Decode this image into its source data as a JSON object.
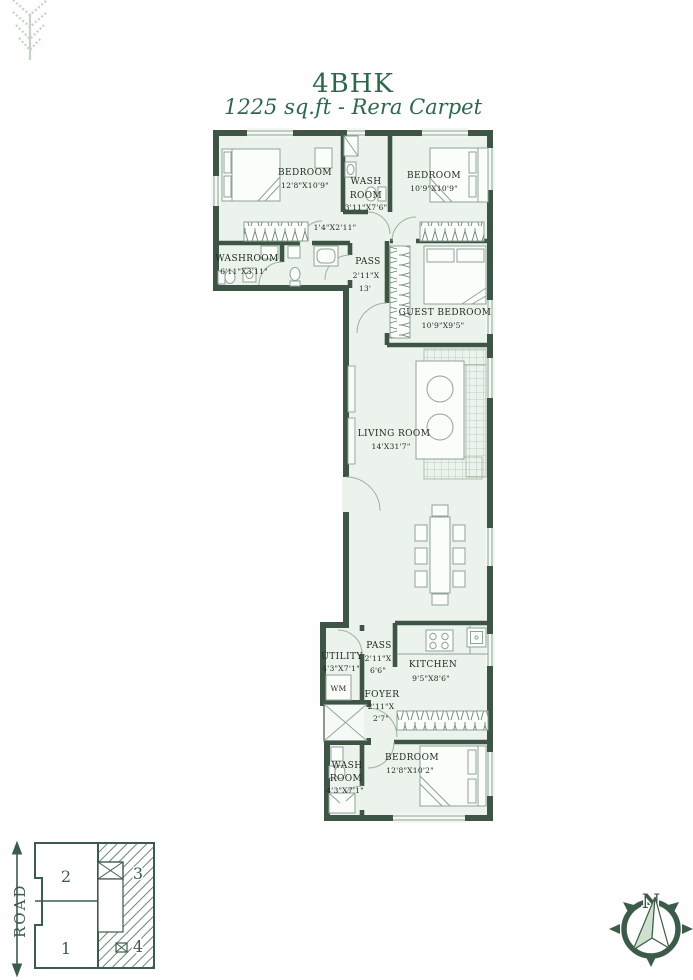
{
  "title": {
    "line1": "4BHK",
    "line2": "1225 sq.ft - Rera Carpet"
  },
  "colors": {
    "wall": "#3e5546",
    "floor": "#ecf3ed",
    "accent_green": "#2d684c",
    "furniture_line": "#8fa396",
    "label_text": "#222c1d",
    "keyplan_green": "#3d5b4a",
    "leaf_logo": "#c7d2c5"
  },
  "rooms": {
    "bedroom_top_left": {
      "name": "BEDROOM",
      "dims": "12'8\"X10'9\""
    },
    "washroom_top": {
      "name_line1": "WASH",
      "name_line2": "ROOM",
      "dims": "3'11\"X7'6\""
    },
    "bedroom_top_right": {
      "name": "BEDROOM",
      "dims": "10'9\"X10'9\""
    },
    "mini_passage": {
      "dims": "1'4\"X2'11\""
    },
    "washroom_left": {
      "name": "WASHROOM",
      "dims": "6'11\"X3'11\""
    },
    "passage_main": {
      "name": "PASS",
      "dims_line1": "2'11\"X",
      "dims_line2": "13'"
    },
    "guest_bedroom": {
      "name": "GUEST BEDROOM",
      "dims": "10'9\"X9'5\""
    },
    "living_room": {
      "name": "LIVING ROOM",
      "dims": "14'X31'7\""
    },
    "utility": {
      "name": "UTILITY",
      "dims": "4'3\"X7'1\"",
      "appliance": "WM"
    },
    "passage_kitchen": {
      "name": "PASS",
      "dims_line1": "2'11\"X",
      "dims_line2": "6'6\""
    },
    "kitchen": {
      "name": "KITCHEN",
      "dims": "9'5\"X8'6\""
    },
    "foyer": {
      "name": "FOYER",
      "dims_line1": "2'11\"X",
      "dims_line2": "2'7\""
    },
    "washroom_bottom": {
      "name_line1": "WASH",
      "name_line2": "ROOM",
      "dims": "4'3\"X7'1\""
    },
    "bedroom_bottom": {
      "name": "BEDROOM",
      "dims": "12'8\"X10'2\""
    }
  },
  "key_plan": {
    "road": "ROAD",
    "unit_1": "1",
    "unit_2": "2",
    "unit_3": "3",
    "unit_4": "4"
  },
  "compass": {
    "north": "N"
  }
}
